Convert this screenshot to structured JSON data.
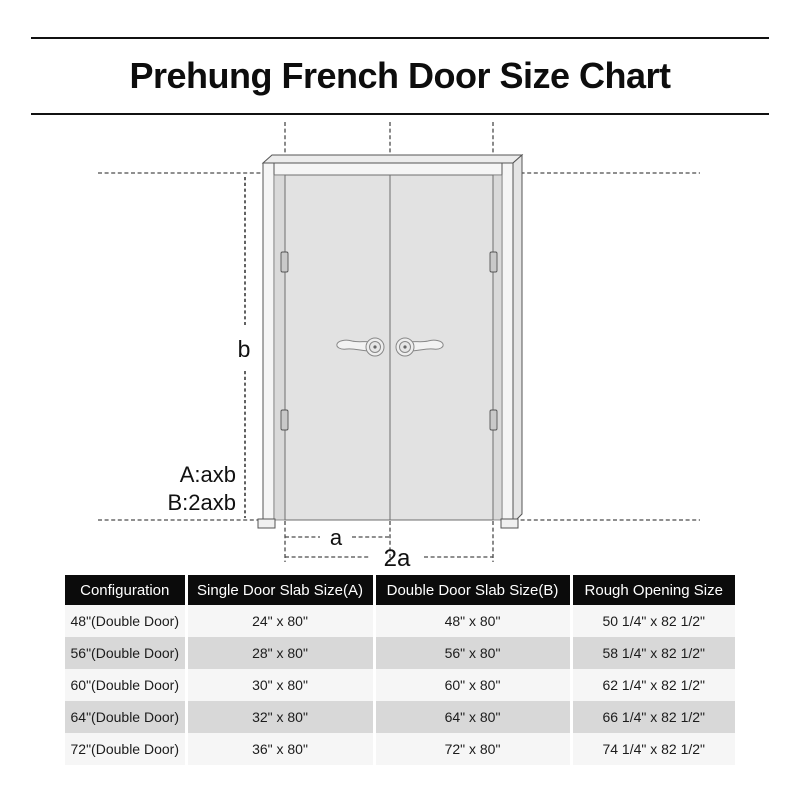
{
  "title": "Prehung French Door Size Chart",
  "diagram": {
    "door_height_label": "b",
    "single_door_width_label": "a",
    "double_door_width_label": "2a",
    "single_formula": "A:axb",
    "double_formula": "B:2axb"
  },
  "table": {
    "columns": [
      "Configuration",
      "Single Door Slab Size(A)",
      "Double Door Slab Size(B)",
      "Rough Opening Size"
    ],
    "rows": [
      [
        "48\"(Double Door)",
        "24\" x 80\"",
        "48\" x 80\"",
        "50 1/4\" x 82 1/2\""
      ],
      [
        "56\"(Double Door)",
        "28\" x 80\"",
        "56\" x 80\"",
        "58 1/4\" x 82 1/2\""
      ],
      [
        "60\"(Double Door)",
        "30\" x 80\"",
        "60\" x 80\"",
        "62 1/4\" x 82 1/2\""
      ],
      [
        "64\"(Double Door)",
        "32\" x 80\"",
        "64\" x 80\"",
        "66 1/4\" x 82 1/2\""
      ],
      [
        "72\"(Double Door)",
        "36\" x 80\"",
        "72\" x 80\"",
        "74 1/4\" x 82 1/2\""
      ]
    ]
  },
  "colors": {
    "header_bg": "#0b0b0b",
    "header_text": "#ffffff",
    "row_light": "#f6f6f6",
    "row_dark": "#d8d8d8",
    "line": "#4c4c4c",
    "frame_fill": "#f5f5f5",
    "door_fill": "#e2e2e2"
  }
}
